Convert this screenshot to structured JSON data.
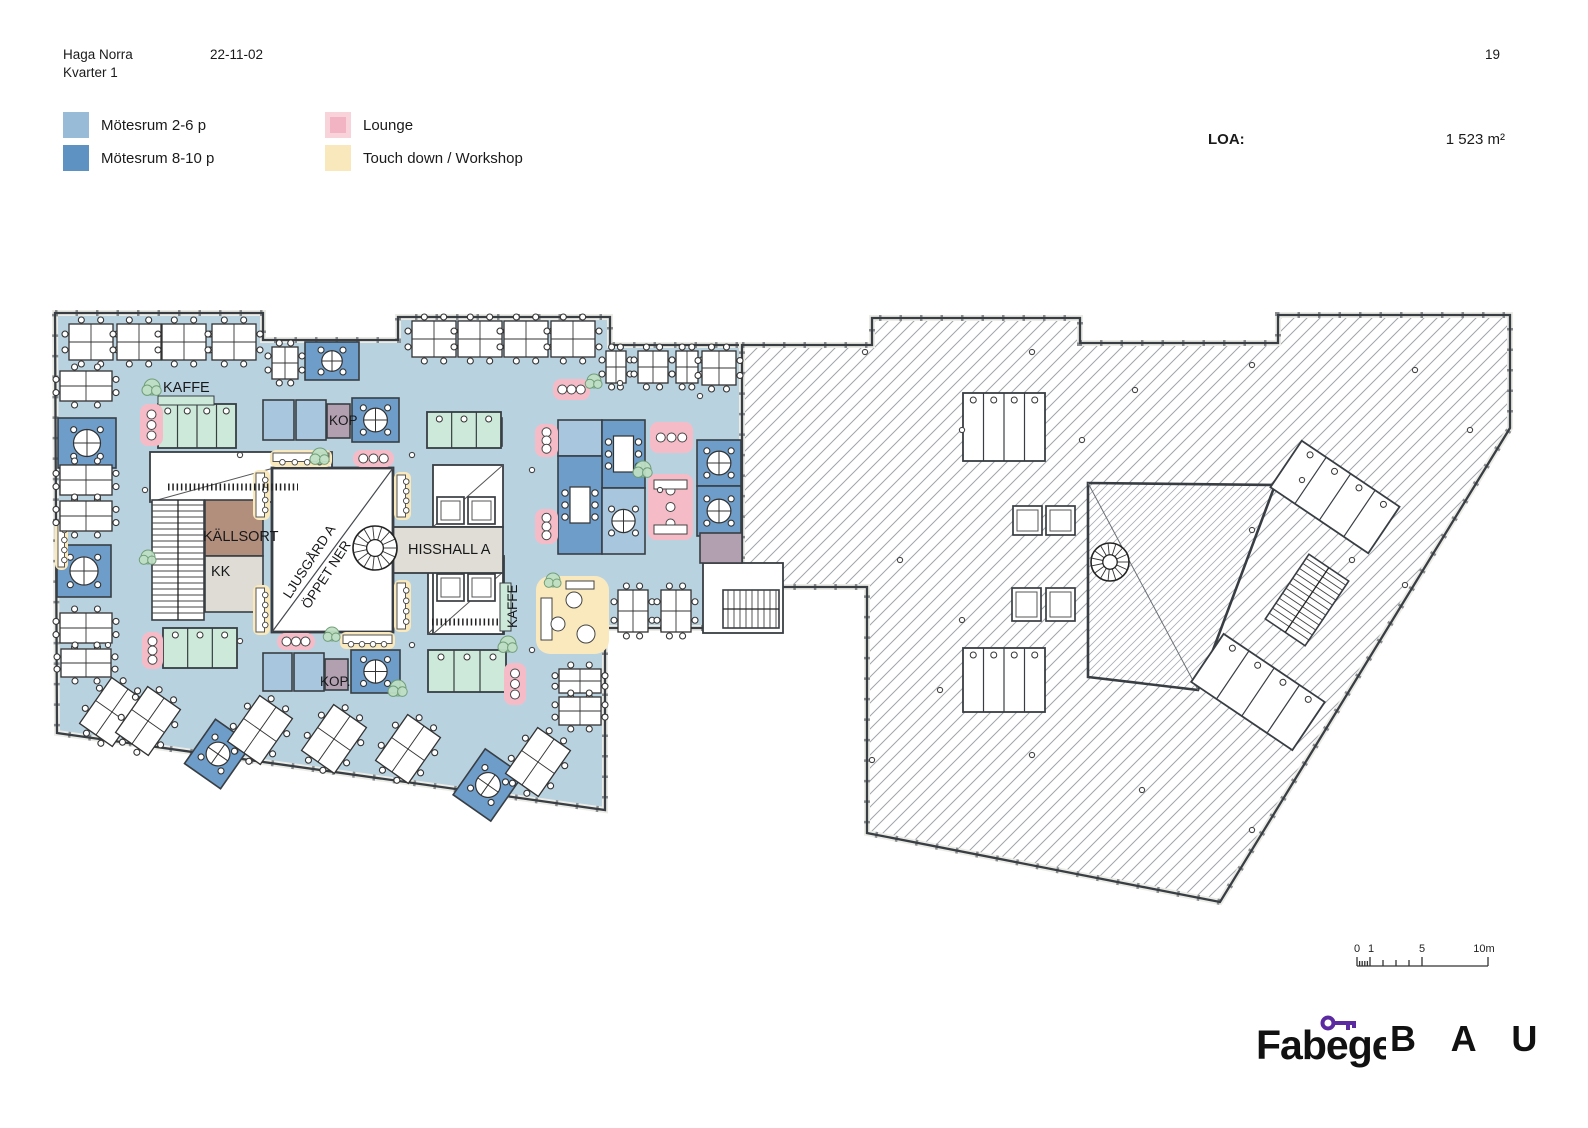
{
  "header": {
    "project": "Haga Norra",
    "block": "Kvarter 1",
    "date": "22-11-02",
    "page": "19"
  },
  "legend": {
    "items": [
      {
        "label": "Mötesrum 2-6 p",
        "color": "#98bcd8"
      },
      {
        "label": "Mötesrum 8-10 p",
        "color": "#5d92c2"
      },
      {
        "label": "Lounge",
        "color": "#f2b3c3"
      },
      {
        "label": "Touch down / Workshop",
        "color": "#f9e8bb"
      }
    ]
  },
  "area": {
    "label": "LOA:",
    "value": "1 523 m²"
  },
  "plan_labels": {
    "kaffe_top": "KAFFE",
    "kop_top": "KOP",
    "kallsort": "KÄLLSORT",
    "kk": "KK",
    "ljusgard_line1": "LJUSGÅRD A",
    "ljusgard_line2": "ÖPPET NER",
    "hisshall": "HISSHALL A",
    "kaffe_side": "KAFFE",
    "kop_bottom": "KOP."
  },
  "scalebar": {
    "t0": "0",
    "t1": "1",
    "t5": "5",
    "t10": "10m"
  },
  "footer": {
    "brand1": "Fabege",
    "brand2": "B A U"
  },
  "colors": {
    "floor": "#b9d2e0",
    "room_light": "#a8c6de",
    "room_dark": "#6d9dc8",
    "lounge_pink": "#f5bcc8",
    "touchdown_yellow": "#f9e9bd",
    "wc_mint": "#cde9d9",
    "copy_purple": "#b2a0b1",
    "kallsort_brown": "#b28e7d",
    "kk_gray": "#dedcd4",
    "corridor_gray": "#dfddd5",
    "wall": "#383e43",
    "hatch_line": "#9fa5aa",
    "tree": "#bfe0c4",
    "tree_edge": "#6d9c74",
    "brand_purple": "#5b2aa0"
  },
  "plan": {
    "outline_left": "55,313 263,313 263,340 398,340 398,317 610,317 610,345 742,345 742,628 605,628 605,810 57,733",
    "outline_right": "742,345 872,345 872,318 1080,318 1080,343 1278,343 1278,315 1510,315 1510,428 1220,902 867,833 867,587 742,587",
    "trapezoid": "1088,483 1275,485 1198,690 1088,677",
    "trapezoid_diag": [
      1088,
      483,
      1198,
      690
    ],
    "ljusgard": {
      "x": 272,
      "y": 468,
      "w": 121,
      "h": 164
    },
    "rooms": [
      {
        "x": 58,
        "y": 418,
        "w": 58,
        "h": 50,
        "f": "dark",
        "t": "x"
      },
      {
        "x": 57,
        "y": 545,
        "w": 54,
        "h": 52,
        "f": "dark",
        "t": "x"
      },
      {
        "x": 305,
        "y": 342,
        "w": 54,
        "h": 38,
        "f": "dark",
        "t": "x"
      },
      {
        "x": 263,
        "y": 400,
        "w": 31,
        "h": 40,
        "f": "light",
        "t": "none"
      },
      {
        "x": 296,
        "y": 400,
        "w": 30,
        "h": 40,
        "f": "light",
        "t": "none"
      },
      {
        "x": 327,
        "y": 404,
        "w": 23,
        "h": 34,
        "f": "purple",
        "t": "none"
      },
      {
        "x": 352,
        "y": 398,
        "w": 47,
        "h": 44,
        "f": "dark",
        "t": "x"
      },
      {
        "x": 558,
        "y": 420,
        "w": 44,
        "h": 36,
        "f": "light",
        "t": "none"
      },
      {
        "x": 602,
        "y": 420,
        "w": 43,
        "h": 68,
        "f": "dark",
        "t": "rect"
      },
      {
        "x": 558,
        "y": 456,
        "w": 44,
        "h": 98,
        "f": "dark",
        "t": "rect"
      },
      {
        "x": 602,
        "y": 488,
        "w": 43,
        "h": 66,
        "f": "light",
        "t": "x"
      },
      {
        "x": 697,
        "y": 440,
        "w": 44,
        "h": 46,
        "f": "dark",
        "t": "x"
      },
      {
        "x": 697,
        "y": 486,
        "w": 44,
        "h": 50,
        "f": "dark",
        "t": "x"
      },
      {
        "x": 263,
        "y": 653,
        "w": 29,
        "h": 38,
        "f": "light",
        "t": "none"
      },
      {
        "x": 294,
        "y": 653,
        "w": 30,
        "h": 38,
        "f": "light",
        "t": "none"
      },
      {
        "x": 325,
        "y": 659,
        "w": 23,
        "h": 31,
        "f": "purple",
        "t": "none"
      },
      {
        "x": 351,
        "y": 650,
        "w": 49,
        "h": 43,
        "f": "dark",
        "t": "x"
      },
      {
        "x": 205,
        "y": 500,
        "w": 58,
        "h": 56,
        "f": "brown",
        "t": "none"
      },
      {
        "x": 205,
        "y": 556,
        "w": 58,
        "h": 56,
        "f": "gray",
        "t": "none"
      },
      {
        "x": 700,
        "y": 533,
        "w": 42,
        "h": 30,
        "f": "purple",
        "t": "none"
      },
      {
        "x": 489,
        "y": 418,
        "w": 13,
        "h": 28,
        "f": "purple",
        "t": "none"
      },
      {
        "x": 196,
        "y": 727,
        "w": 44,
        "h": 54,
        "f": "dark",
        "t": "x",
        "rot": 35
      },
      {
        "x": 465,
        "y": 757,
        "w": 46,
        "h": 56,
        "f": "dark",
        "t": "x",
        "rot": 35
      }
    ],
    "white_rooms": [
      {
        "x": 150,
        "y": 452,
        "w": 182,
        "h": 50,
        "diag": true
      },
      {
        "x": 428,
        "y": 556,
        "w": 76,
        "h": 78,
        "diag": true
      },
      {
        "x": 433,
        "y": 465,
        "w": 70,
        "h": 62,
        "diag": true
      },
      {
        "x": 433,
        "y": 572,
        "w": 70,
        "h": 62,
        "diag": true
      },
      {
        "x": 703,
        "y": 563,
        "w": 80,
        "h": 70,
        "diag": false
      }
    ],
    "corridor": {
      "x": 393,
      "y": 527,
      "w": 110,
      "h": 46
    },
    "wc": [
      {
        "x": 158,
        "y": 404,
        "w": 78,
        "h": 44,
        "n": 4,
        "f": "mint"
      },
      {
        "x": 427,
        "y": 412,
        "w": 74,
        "h": 36,
        "n": 3,
        "f": "mint"
      },
      {
        "x": 163,
        "y": 628,
        "w": 74,
        "h": 40,
        "n": 3,
        "f": "mint"
      },
      {
        "x": 428,
        "y": 650,
        "w": 78,
        "h": 42,
        "n": 3,
        "f": "mint"
      },
      {
        "x": 963,
        "y": 393,
        "w": 82,
        "h": 68,
        "n": 4,
        "f": "white"
      },
      {
        "x": 963,
        "y": 648,
        "w": 82,
        "h": 64,
        "n": 4,
        "f": "white"
      },
      {
        "x": 1276,
        "y": 469,
        "w": 118,
        "h": 56,
        "n": 4,
        "f": "white",
        "rot": 34
      },
      {
        "x": 1197,
        "y": 663,
        "w": 122,
        "h": 58,
        "n": 4,
        "f": "white",
        "rot": 34
      }
    ],
    "green_strips": [
      [
        158,
        396,
        56,
        9
      ],
      [
        500,
        583,
        11,
        48
      ]
    ],
    "elevators": [
      [
        437,
        497,
        27,
        27
      ],
      [
        468,
        497,
        27,
        27
      ],
      [
        437,
        574,
        27,
        27
      ],
      [
        468,
        574,
        27,
        27
      ],
      [
        1013,
        506,
        29,
        29
      ],
      [
        1046,
        506,
        29,
        29
      ],
      [
        1012,
        588,
        29,
        33
      ],
      [
        1046,
        588,
        29,
        33
      ]
    ],
    "stairs": [
      {
        "x": 152,
        "y": 500,
        "w": 52,
        "h": 120,
        "dir": "v"
      },
      {
        "x": 723,
        "y": 590,
        "w": 56,
        "h": 38,
        "dir": "h"
      },
      {
        "x": 1283,
        "y": 561,
        "w": 48,
        "h": 78,
        "dir": "v",
        "rot": 34
      }
    ],
    "spirals": [
      [
        375,
        548,
        22
      ],
      [
        1110,
        562,
        19
      ]
    ],
    "benches": [
      [
        253,
        470,
        17,
        50
      ],
      [
        253,
        585,
        17,
        50
      ],
      [
        394,
        472,
        17,
        48
      ],
      [
        394,
        580,
        17,
        52
      ],
      [
        270,
        450,
        62,
        17
      ],
      [
        340,
        632,
        55,
        17
      ],
      [
        55,
        520,
        13,
        50
      ]
    ],
    "ylounge": {
      "x": 536,
      "y": 576,
      "w": 73,
      "h": 78
    },
    "pink": [
      [
        140,
        404,
        23,
        42
      ],
      [
        553,
        379,
        37,
        21
      ],
      [
        650,
        422,
        43,
        31
      ],
      [
        648,
        474,
        45,
        66
      ],
      [
        535,
        424,
        23,
        33
      ],
      [
        535,
        509,
        23,
        35
      ],
      [
        142,
        632,
        21,
        37
      ],
      [
        504,
        663,
        22,
        42
      ],
      [
        353,
        450,
        41,
        17
      ],
      [
        277,
        633,
        38,
        17
      ]
    ],
    "combs": [
      [
        168,
        487,
        298,
        487
      ],
      [
        432,
        622,
        498,
        622
      ]
    ],
    "desks": [
      [
        91,
        342,
        44,
        36,
        0
      ],
      [
        139,
        342,
        44,
        36,
        0
      ],
      [
        184,
        342,
        44,
        36,
        0
      ],
      [
        234,
        342,
        44,
        36,
        0
      ],
      [
        285,
        363,
        26,
        32,
        0
      ],
      [
        434,
        339,
        44,
        36,
        0
      ],
      [
        480,
        339,
        44,
        36,
        0
      ],
      [
        526,
        339,
        44,
        36,
        0
      ],
      [
        573,
        339,
        44,
        36,
        0
      ],
      [
        616,
        367,
        20,
        32,
        0
      ],
      [
        653,
        367,
        30,
        32,
        0
      ],
      [
        687,
        367,
        22,
        32,
        0
      ],
      [
        719,
        368,
        34,
        34,
        0
      ],
      [
        86,
        386,
        52,
        30,
        0
      ],
      [
        86,
        480,
        52,
        30,
        0
      ],
      [
        86,
        516,
        52,
        30,
        0
      ],
      [
        86,
        628,
        52,
        30,
        0
      ],
      [
        86,
        663,
        50,
        28,
        0
      ],
      [
        633,
        611,
        30,
        42,
        0
      ],
      [
        676,
        611,
        30,
        42,
        0
      ],
      [
        580,
        681,
        42,
        24,
        0
      ],
      [
        580,
        711,
        42,
        28,
        0
      ],
      [
        112,
        712,
        40,
        56,
        35
      ],
      [
        148,
        721,
        40,
        56,
        35
      ],
      [
        260,
        730,
        40,
        56,
        35
      ],
      [
        334,
        739,
        40,
        56,
        35
      ],
      [
        408,
        749,
        40,
        56,
        35
      ],
      [
        538,
        762,
        40,
        56,
        35
      ]
    ],
    "trees": [
      [
        152,
        387,
        8
      ],
      [
        320,
        456,
        8
      ],
      [
        148,
        557,
        7
      ],
      [
        643,
        469,
        8
      ],
      [
        553,
        580,
        7
      ],
      [
        508,
        644,
        8
      ],
      [
        398,
        688,
        8
      ],
      [
        594,
        381,
        7
      ],
      [
        332,
        634,
        7
      ]
    ],
    "dots": [
      [
        660,
        490
      ],
      [
        145,
        490
      ],
      [
        240,
        455
      ],
      [
        412,
        455
      ],
      [
        532,
        470
      ],
      [
        620,
        383
      ],
      [
        700,
        396
      ],
      [
        240,
        641
      ],
      [
        412,
        645
      ],
      [
        532,
        650
      ],
      [
        108,
        645
      ],
      [
        865,
        352
      ],
      [
        962,
        430
      ],
      [
        1032,
        352
      ],
      [
        1135,
        390
      ],
      [
        1252,
        365
      ],
      [
        1415,
        370
      ],
      [
        900,
        560
      ],
      [
        962,
        620
      ],
      [
        1082,
        440
      ],
      [
        1252,
        530
      ],
      [
        1352,
        560
      ],
      [
        1302,
        480
      ],
      [
        940,
        690
      ],
      [
        1032,
        755
      ],
      [
        1142,
        790
      ],
      [
        1252,
        830
      ],
      [
        872,
        760
      ],
      [
        1470,
        430
      ],
      [
        1405,
        585
      ]
    ]
  }
}
